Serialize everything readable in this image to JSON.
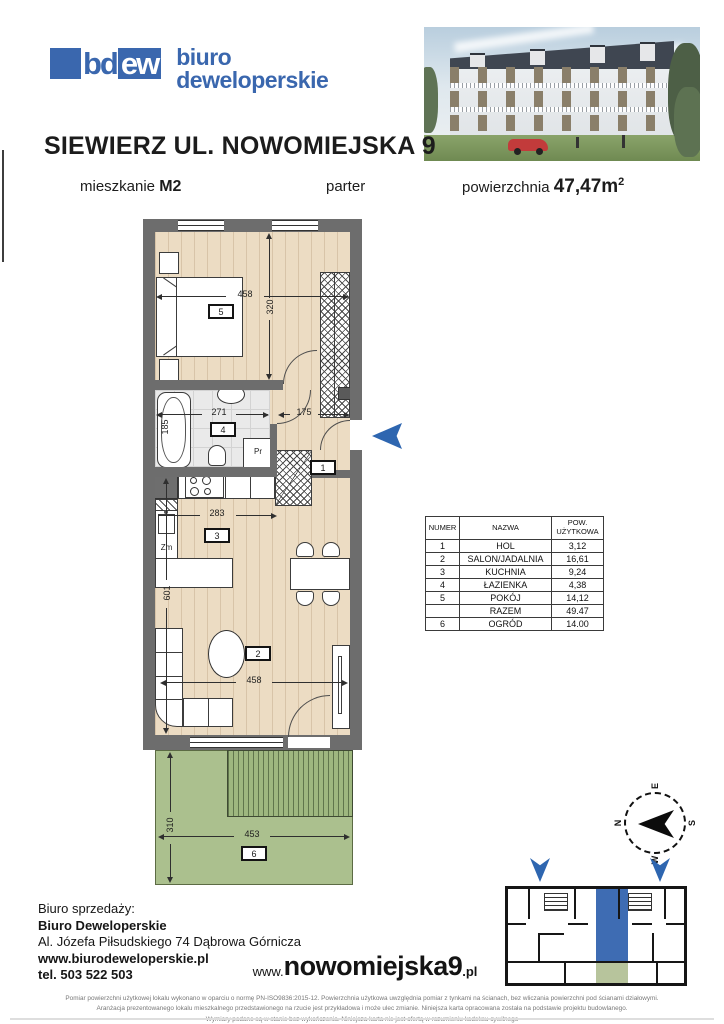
{
  "logo": {
    "mark_bd": "bd",
    "mark_ew": "ew",
    "name_line1": "biuro",
    "name_line2": "deweloperskie"
  },
  "header": {
    "title": "SIEWIERZ UL. NOWOMIEJSKA 9",
    "unit_label": "mieszkanie",
    "unit_value": "M2",
    "floor": "parter",
    "area_label": "powierzchnia",
    "area_value": "47,47m",
    "area_sup": "2"
  },
  "plan": {
    "dims": {
      "bedroom_w": "458",
      "bedroom_h": "320",
      "bath_w": "271",
      "bath_h": "185",
      "hall_w": "175",
      "kitchen_w": "283",
      "living_h": "601",
      "living_w": "458",
      "garden_h": "310",
      "garden_w": "453"
    },
    "labels": {
      "washer": "Pr",
      "dishwasher": "Zm"
    },
    "rooms": {
      "hall": "1",
      "living": "2",
      "kitchen": "3",
      "bath": "4",
      "bedroom": "5",
      "garden": "6"
    }
  },
  "table": {
    "headers": [
      "NUMER",
      "NAZWA",
      "POW. UŻYTKOWA"
    ],
    "rows": [
      [
        "1",
        "HOL",
        "3,12"
      ],
      [
        "2",
        "SALON/JADALNIA",
        "16,61"
      ],
      [
        "3",
        "KUCHNIA",
        "9,24"
      ],
      [
        "4",
        "ŁAZIENKA",
        "4,38"
      ],
      [
        "5",
        "POKÓJ",
        "14,12"
      ],
      [
        "",
        "RAZEM",
        "49.47"
      ],
      [
        "6",
        "OGRÓD",
        "14.00"
      ]
    ]
  },
  "compass": {
    "n": "N",
    "e": "E",
    "s": "S",
    "w": "W"
  },
  "contact": {
    "heading": "Biuro sprzedaży:",
    "company": "Biuro Deweloperskie",
    "address": "Al. Józefa Piłsudskiego 74 Dąbrowa Górnicza",
    "website": "www.biurodeweloperskie.pl",
    "phone": "tel. 503 522 503"
  },
  "site": {
    "prefix": "www.",
    "name": "nowomiejska9",
    "tld": ".pl"
  },
  "legal": {
    "line1": "Pomiar powierzchni użytkowej lokalu wykonano w oparciu o normę PN-ISO9836:2015-12. Powierzchnia użytkowa uwzględnia pomiar z tynkami na ścianach, bez wliczania powierzchni pod ścianami działowymi.",
    "line2": "Aranżacja prezentowanego lokalu mieszkalnego przedstawionego na rzucie jest przykładowa i może ulec zmianie. Niniejsza karta opracowana została na podstawie projektu budowlanego.",
    "line3": "Wymiary podane są w stanie bez wykończenia. Niniejsza karta nie jest ofertą w rozumieniu kodeksu cywilnego"
  }
}
